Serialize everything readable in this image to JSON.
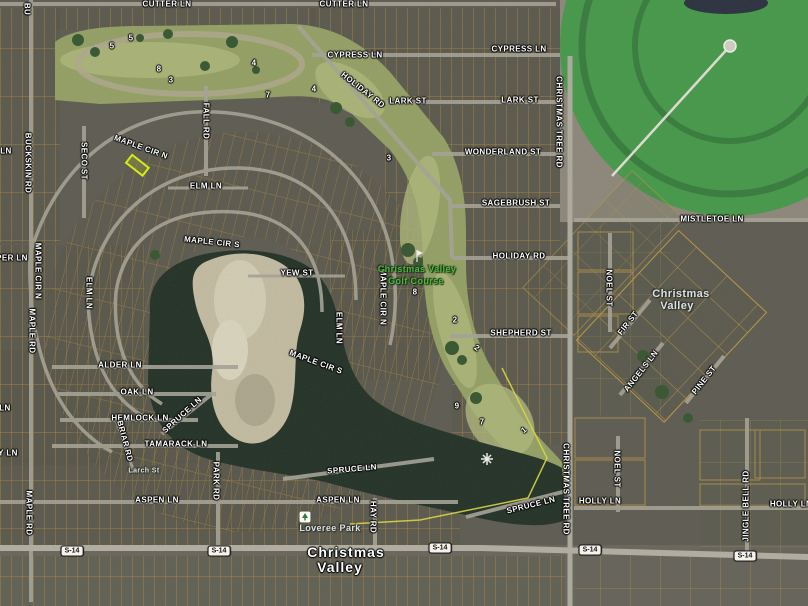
{
  "colors": {
    "terrain_base": "#5a594e",
    "parcel_line": "#b5893a",
    "parcel_line_big": "#c49a3e",
    "road_gray": "#aba89b",
    "highway_gray": "#b8b5a8",
    "golf_green": "#96a562",
    "fairway_light": "#b5c07c",
    "tree_green": "#2d5128",
    "water_dark": "#18281e",
    "island_tan": "#cbc4a8",
    "crop_circle_green": "#3f9d45",
    "field_corner_tan": "#8e8a7b",
    "golf_boundary_yellow": "#e8e23a",
    "highlight_lot": "#e2ff00",
    "label_white": "#ffffff",
    "place_label_gray": "#dde2e4",
    "golf_label_green": "#54b547"
  },
  "badge": {
    "label": "S-14"
  },
  "streets": {
    "cutter_1": "CUTTER LN",
    "cutter_2": "CUTTER LN",
    "cypress_1": "CYPRESS LN",
    "cypress_2": "CYPRESS LN",
    "lark_1": "LARK ST",
    "lark_2": "LARK ST",
    "holiday_diag": "HOLIDAY RD",
    "holiday_e": "HOLIDAY RD",
    "wonderland": "WONDERLAND ST",
    "sagebrush": "SAGEBRUSH ST",
    "mistletoe": "MISTLETOE LN",
    "shepherd": "SHEPHERD ST",
    "christmas_tree_n": "CHRISTMAS TREE RD",
    "christmas_tree_s": "CHRISTMAS TREE RD",
    "noel_n": "NOEL ST",
    "noel_s": "NOEL ST",
    "fir": "FIR ST",
    "angels": "ANGELS LN",
    "pine": "PINE ST",
    "jingle_bell": "JINGLE BELL RD",
    "holly_w": "HOLLY LN",
    "holly_e": "HOLLY LN",
    "maple_cir_n_top": "MAPLE CIR N",
    "maple_cir_n_w": "MAPLE CIR N",
    "maple_cir_n_e": "MAPLE CIR N",
    "maple_cir_s_top": "MAPLE CIR S",
    "maple_cir_s_se": "MAPLE CIR S",
    "elm_top": "ELM LN",
    "elm_w": "ELM LN",
    "elm_e": "ELM LN",
    "yew": "YEW ST",
    "fall_rd": "FALL RD",
    "seco": "SECO ST",
    "buckskin": "BUCKSKIN RD",
    "buckskin_partial": "BU",
    "maple_rd_n": "MAPLE RD",
    "maple_rd_s": "MAPLE RD",
    "alder": "ALDER LN",
    "oak": "OAK LN",
    "hemlock": "HEMLOCK LN",
    "briar": "BRIAR RD",
    "tamarack": "TAMARACK LN",
    "spruce_ne": "SPRUCE LN",
    "spruce_mid": "SPRUCE LN",
    "spruce_se": "SPRUCE LN",
    "aspen_w": "ASPEN LN",
    "aspen_e": "ASPEN LN",
    "park_rd": "PARK RD",
    "hay_rd": "HAY RD",
    "larch": "Larch St",
    "edge_partial_1": "LN",
    "edge_partial_2": "PER LN",
    "edge_partial_3": "LN",
    "edge_partial_4": "Y LN"
  },
  "places": {
    "town_right_line1": "Christmas",
    "town_right_line2": "Valley",
    "town_bottom_line1": "Christmas",
    "town_bottom_line2": "Valley",
    "golf_line1": "Christmas Valley",
    "golf_line2": "Golf Course",
    "park": "Loveree Park"
  },
  "golf_holes": {
    "h5a": "5",
    "h5b": "5",
    "h8a": "8",
    "h3a": "3",
    "h4a": "4",
    "h7a": "7",
    "h4b": "4",
    "h3b": "3",
    "h8b": "8",
    "h2a": "2",
    "h2b": "2",
    "h9": "9",
    "h7b": "7",
    "h1": "1"
  }
}
